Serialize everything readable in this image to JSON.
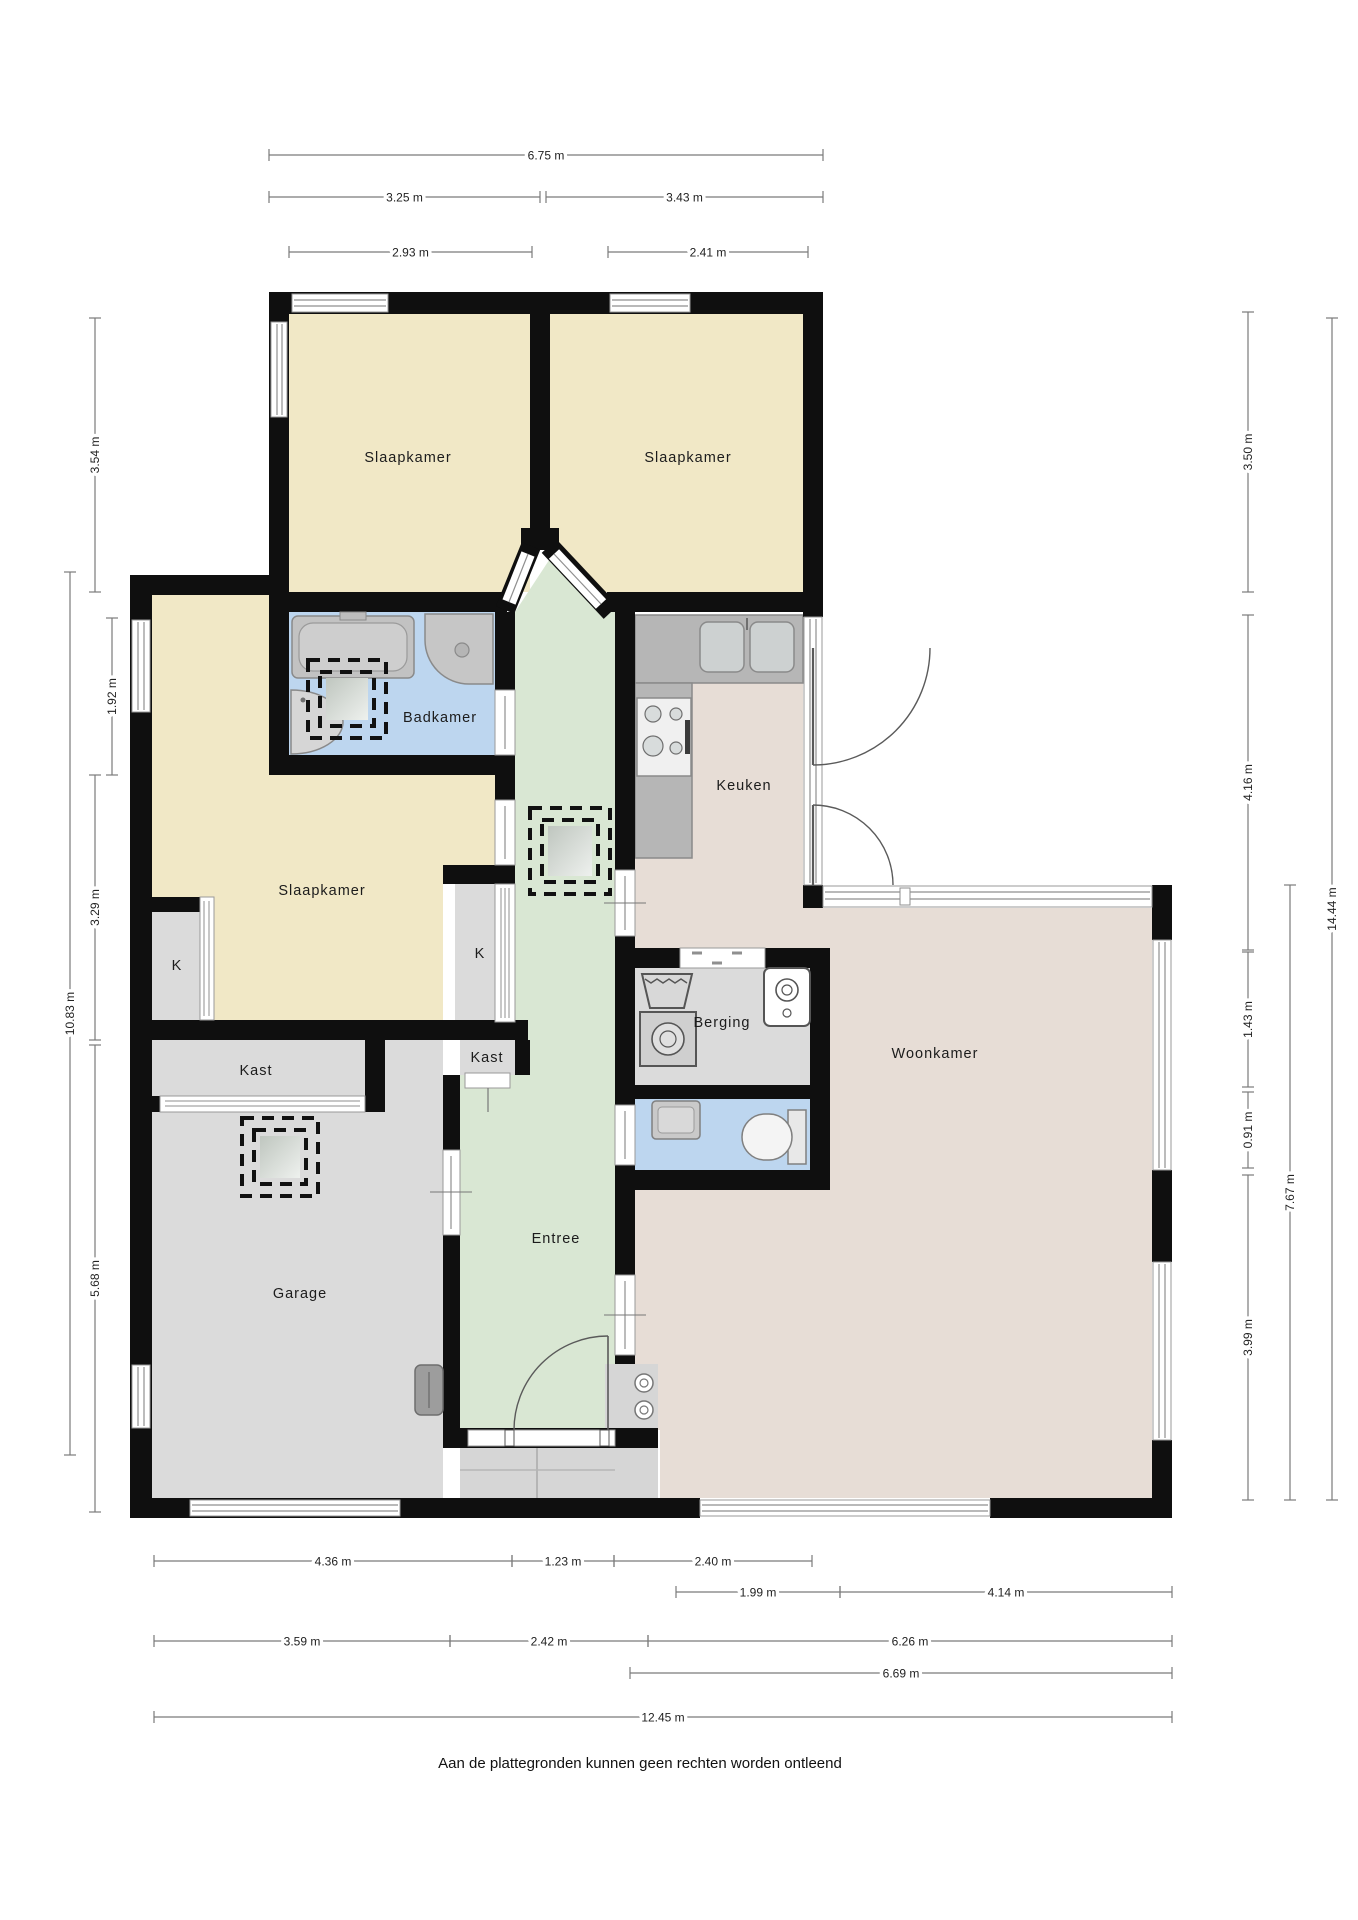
{
  "footer": {
    "text": "Aan de plattegronden kunnen geen rechten worden ontleend"
  },
  "colors": {
    "wall": "#0f0f0f",
    "bedroom_floor": "#f1e8c6",
    "bathroom_floor": "#bdd6ef",
    "toilet_floor": "#bdd6ef",
    "hallway_floor": "#d9e7d3",
    "living_kitchen_floor": "#e7ddd6",
    "utility_floor": "#dbdbdb",
    "porch_floor": "#d6d6d6",
    "counter": "#b6b6b6",
    "dimension_line": "#7a7a7a"
  },
  "rooms": {
    "bedroom_top_left": "Slaapkamer",
    "bedroom_top_right": "Slaapkamer",
    "bedroom_left": "Slaapkamer",
    "bathroom": "Badkamer",
    "kitchen": "Keuken",
    "storage": "Berging",
    "hallway": "Entree",
    "living_room": "Woonkamer",
    "garage": "Garage",
    "closet_small_left": "K",
    "closet_small_right": "K",
    "closet_garage": "Kast",
    "closet_hall": "Kast"
  },
  "room_labels": [
    {
      "text": "Slaapkamer",
      "x": 408,
      "y": 462,
      "name": "room-label-bedroom-top-left"
    },
    {
      "text": "Slaapkamer",
      "x": 688,
      "y": 462,
      "name": "room-label-bedroom-top-right"
    },
    {
      "text": "Badkamer",
      "x": 440,
      "y": 722,
      "name": "room-label-bathroom"
    },
    {
      "text": "Keuken",
      "x": 744,
      "y": 790,
      "name": "room-label-kitchen"
    },
    {
      "text": "Slaapkamer",
      "x": 322,
      "y": 895,
      "name": "room-label-bedroom-left"
    },
    {
      "text": "K",
      "x": 177,
      "y": 970,
      "name": "room-label-closet-small-left"
    },
    {
      "text": "K",
      "x": 480,
      "y": 958,
      "name": "room-label-closet-small-right"
    },
    {
      "text": "Kast",
      "x": 256,
      "y": 1075,
      "name": "room-label-closet-garage"
    },
    {
      "text": "Kast",
      "x": 487,
      "y": 1062,
      "name": "room-label-closet-hall"
    },
    {
      "text": "Berging",
      "x": 722,
      "y": 1027,
      "name": "room-label-storage"
    },
    {
      "text": "Entree",
      "x": 556,
      "y": 1243,
      "name": "room-label-hallway"
    },
    {
      "text": "Woonkamer",
      "x": 935,
      "y": 1058,
      "name": "room-label-living-room"
    },
    {
      "text": "Garage",
      "x": 300,
      "y": 1298,
      "name": "room-label-garage"
    }
  ],
  "dimensions": {
    "top": [
      {
        "label": "6.75 m",
        "x1": 269,
        "x2": 823,
        "y": 155
      },
      {
        "label": "3.25 m",
        "x1": 269,
        "x2": 540,
        "y": 197
      },
      {
        "label": "3.43 m",
        "x1": 546,
        "x2": 823,
        "y": 197
      },
      {
        "label": "2.93 m",
        "x1": 289,
        "x2": 532,
        "y": 252
      },
      {
        "label": "2.41 m",
        "x1": 608,
        "x2": 808,
        "y": 252
      }
    ],
    "bottom": [
      {
        "label": "4.36 m",
        "x1": 154,
        "x2": 512,
        "y": 1561
      },
      {
        "label": "1.23 m",
        "x1": 512,
        "x2": 614,
        "y": 1561
      },
      {
        "label": "2.40 m",
        "x1": 614,
        "x2": 812,
        "y": 1561
      },
      {
        "label": "1.99 m",
        "x1": 676,
        "x2": 840,
        "y": 1592
      },
      {
        "label": "4.14 m",
        "x1": 840,
        "x2": 1172,
        "y": 1592
      },
      {
        "label": "3.59 m",
        "x1": 154,
        "x2": 450,
        "y": 1641
      },
      {
        "label": "2.42 m",
        "x1": 450,
        "x2": 648,
        "y": 1641
      },
      {
        "label": "6.26 m",
        "x1": 648,
        "x2": 1172,
        "y": 1641
      },
      {
        "label": "6.69 m",
        "x1": 630,
        "x2": 1172,
        "y": 1673
      },
      {
        "label": "12.45 m",
        "x1": 154,
        "x2": 1172,
        "y": 1717
      }
    ],
    "left": [
      {
        "label": "3.54 m",
        "y1": 318,
        "y2": 592,
        "x": 95
      },
      {
        "label": "1.92 m",
        "y1": 618,
        "y2": 775,
        "x": 112
      },
      {
        "label": "3.29 m",
        "y1": 775,
        "y2": 1040,
        "x": 95
      },
      {
        "label": "10.83 m",
        "y1": 572,
        "y2": 1455,
        "x": 70
      },
      {
        "label": "5.68 m",
        "y1": 1045,
        "y2": 1512,
        "x": 95
      }
    ],
    "right": [
      {
        "label": "3.50 m",
        "y1": 312,
        "y2": 592,
        "x": 1248
      },
      {
        "label": "4.16 m",
        "y1": 615,
        "y2": 950,
        "x": 1248
      },
      {
        "label": "1.43 m",
        "y1": 952,
        "y2": 1087,
        "x": 1248
      },
      {
        "label": "0.91 m",
        "y1": 1092,
        "y2": 1168,
        "x": 1248
      },
      {
        "label": "3.99 m",
        "y1": 1175,
        "y2": 1500,
        "x": 1248
      },
      {
        "label": "7.67 m",
        "y1": 885,
        "y2": 1500,
        "x": 1290
      },
      {
        "label": "14.44 m",
        "y1": 318,
        "y2": 1500,
        "x": 1332
      }
    ]
  },
  "fixtures": {
    "bathtub": "bathtub-icon",
    "shower": "shower-icon",
    "washbasin": "washbasin-icon",
    "kitchen_sink": "kitchen-sink-icon",
    "stove": "stove-icon",
    "washing_machine": "washing-machine-icon",
    "laundry_sink": "laundry-sink-icon",
    "boiler": "boiler-icon",
    "toilet": "toilet-icon",
    "toilet_sink": "toilet-sink-icon",
    "heater": "heater-icon",
    "skylight": "skylight-icon",
    "meter_fixtures": "meter-icon"
  }
}
